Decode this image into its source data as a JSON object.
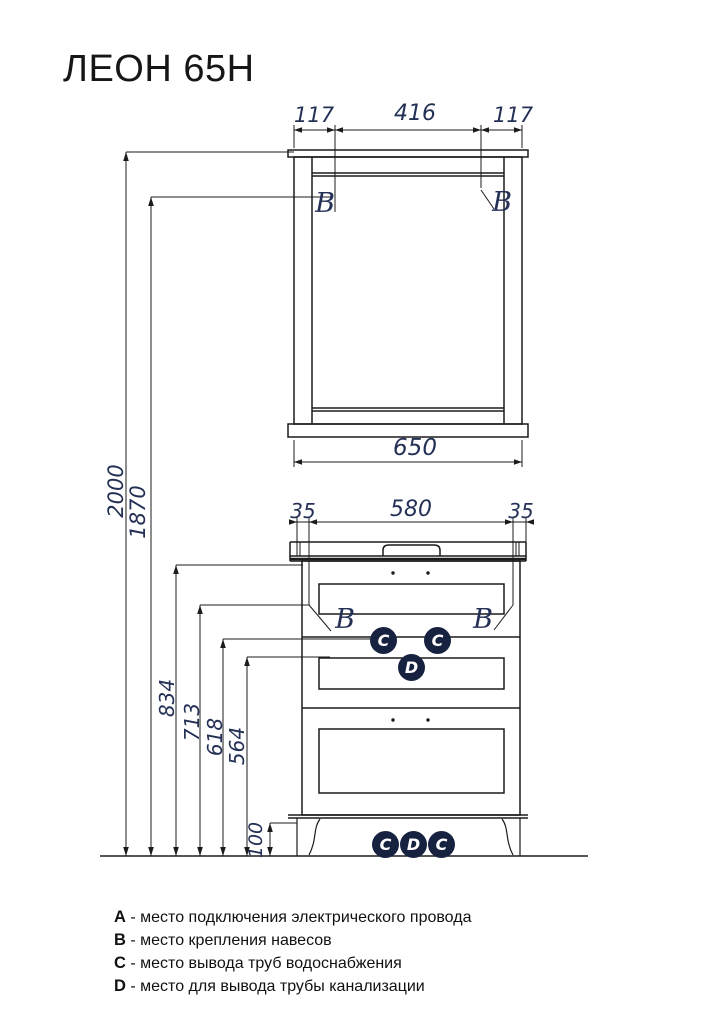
{
  "title": "ЛЕОН 65Н",
  "mirror": {
    "dim_left": "117",
    "dim_center": "416",
    "dim_right": "117",
    "dim_width": "650",
    "hanger_left": "B",
    "hanger_right": "B"
  },
  "cabinet": {
    "dim_left": "35",
    "dim_center": "580",
    "dim_right": "35",
    "hanger_left": "B",
    "hanger_right": "B",
    "mid_badges": [
      "C",
      "C",
      "D"
    ],
    "bottom_badges": [
      "C",
      "D",
      "C"
    ]
  },
  "heights": {
    "total": "2000",
    "mirror_hanger": "1870",
    "cabinet_top": "834",
    "cabinet_hanger": "713",
    "water_outlet": "618",
    "drain_outlet": "564",
    "plinth": "100"
  },
  "legend": [
    {
      "key": "A",
      "text": "- место подключения электрического провода"
    },
    {
      "key": "B",
      "text": "- место крепления навесов"
    },
    {
      "key": "C",
      "text": "- место вывода труб водоснабжения"
    },
    {
      "key": "D",
      "text": "- место для вывода трубы канализации"
    }
  ],
  "colors": {
    "line": "#1b1b1b",
    "dim_text": "#243055",
    "badge_bg": "#172240",
    "badge_text": "#ffffff"
  }
}
